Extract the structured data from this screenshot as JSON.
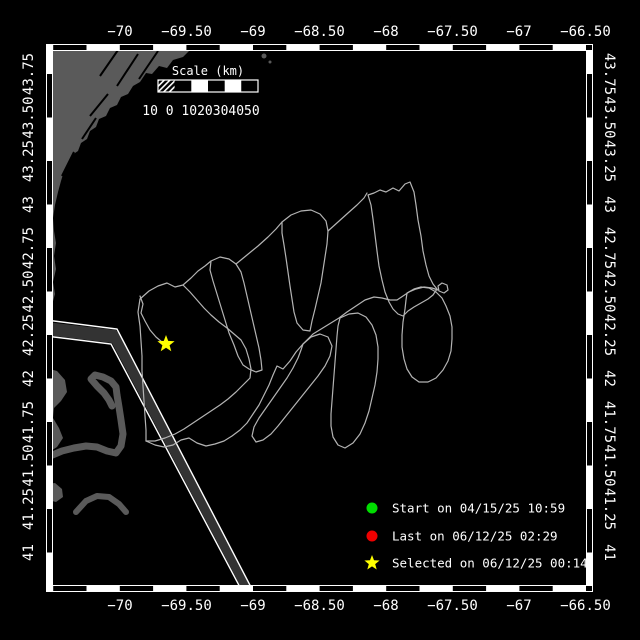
{
  "map": {
    "colors": {
      "background": "#000000",
      "land": "#5a5a5a",
      "track": "#b4b4b4",
      "frame": "#ffffff",
      "start_marker": "#00dd00",
      "last_marker": "#ee0000",
      "selected_marker": "#ffff00",
      "corridor_fill": "#333333"
    },
    "frame": {
      "left": 46,
      "top": 44,
      "right": 593,
      "bottom": 592,
      "inner_left": 52,
      "inner_top": 50,
      "inner_right": 587,
      "inner_bottom": 586,
      "hcells": {
        "first": 53.2,
        "period": 33.3
      },
      "vcells": {
        "first": 74,
        "period": 43.5
      }
    },
    "axes": {
      "top": {
        "y": 36,
        "ticks": [
          {
            "label": "−70",
            "x": 120
          },
          {
            "label": "−69.50",
            "x": 186.5
          },
          {
            "label": "−69",
            "x": 253
          },
          {
            "label": "−68.50",
            "x": 319.5
          },
          {
            "label": "−68",
            "x": 386
          },
          {
            "label": "−67.50",
            "x": 452.5
          },
          {
            "label": "−67",
            "x": 519
          },
          {
            "label": "−66.50",
            "x": 585.5
          }
        ]
      },
      "bottom": {
        "y": 610,
        "ticks": [
          {
            "label": "−70",
            "x": 120
          },
          {
            "label": "−69.50",
            "x": 186.5
          },
          {
            "label": "−69",
            "x": 253
          },
          {
            "label": "−68.50",
            "x": 319.5
          },
          {
            "label": "−68",
            "x": 386
          },
          {
            "label": "−67.50",
            "x": 452.5
          },
          {
            "label": "−67",
            "x": 519
          },
          {
            "label": "−66.50",
            "x": 585.5
          }
        ]
      },
      "left": {
        "x": 33,
        "ticks": [
          {
            "label": "43.75",
            "y": 74
          },
          {
            "label": "43.50",
            "y": 117.5
          },
          {
            "label": "43.25",
            "y": 161
          },
          {
            "label": "43",
            "y": 204.5
          },
          {
            "label": "42.75",
            "y": 248
          },
          {
            "label": "42.50",
            "y": 291.5
          },
          {
            "label": "42.25",
            "y": 335
          },
          {
            "label": "42",
            "y": 378.5
          },
          {
            "label": "41.75",
            "y": 422
          },
          {
            "label": "41.50",
            "y": 465.5
          },
          {
            "label": "41.25",
            "y": 509
          },
          {
            "label": "41",
            "y": 552.5
          }
        ]
      },
      "right": {
        "x": 605,
        "ticks": [
          {
            "label": "43.75",
            "y": 74
          },
          {
            "label": "43.50",
            "y": 117.5
          },
          {
            "label": "43.25",
            "y": 161
          },
          {
            "label": "43",
            "y": 204.5
          },
          {
            "label": "42.75",
            "y": 248
          },
          {
            "label": "42.50",
            "y": 291.5
          },
          {
            "label": "42.25",
            "y": 335
          },
          {
            "label": "42",
            "y": 378.5
          },
          {
            "label": "41.75",
            "y": 422
          },
          {
            "label": "41.50",
            "y": 465.5
          },
          {
            "label": "41.25",
            "y": 509
          },
          {
            "label": "41",
            "y": 552.5
          }
        ]
      }
    },
    "scalebar": {
      "title": "Scale (km)",
      "numbers": "10 0 1020304050",
      "x": 158,
      "y": 80,
      "width": 100,
      "height": 12
    },
    "legend": {
      "items": [
        {
          "marker": "circle",
          "color": "#00dd00",
          "label": "Start on 04/15/25 10:59"
        },
        {
          "marker": "circle",
          "color": "#ee0000",
          "label": "Last on 06/12/25 02:29"
        },
        {
          "marker": "star",
          "color": "#ffff00",
          "label": "Selected on 06/12/25 00:14"
        }
      ]
    },
    "markers": {
      "start": {
        "transform": "translate(146,440)"
      },
      "last": {
        "transform": "translate(170,351)"
      },
      "selected_star_points": "166,335 168.2,340.9 174.6,341.2 169.6,345.2 171.3,351.3 166,347.8 160.7,351.3 162.4,345.2 157.4,341.2 163.8,340.9"
    },
    "legend_star_points": "372,555 374,560.3 379.6,560.5 375.2,564.1 376.7,569.5 372,566.4 367.3,569.5 368.8,564.1 364.4,560.5 370,560.3",
    "land": {
      "maine": "52,50 190,50 183,57 173,60 167,68 159,66 152,74 146,73 140,82 133,86 128,94 121,97 117,105 110,108 106,116 99,119 96,127 90,131 87,139 81,143 78,151 72,155 69,164 64,171 61,181 58,192 55,205 53,218 54,231 56,243 54,256 56,269 53,282 55,294 52,305",
      "streaks": "M118,50 L100,76 M138,54 L117,86 M158,51 L139,79 M96,118 L82,139 M108,94 L90,116 M74,152 L62,176",
      "mainland": "46,368 57,371 65,380 67,392 61,401 54,408 53,418 59,428 63,438 57,447 49,452 46,452",
      "cape_arm": "M50,456 L62,451 74,448 86,446 97,447 107,451 116,453 121,446 123,434 121,420 119,407 117,395 116,387 111,381 103,377 95,375 91,379 97,386 104,393 109,400 112,406",
      "islands": "M76,512 L86,501 97,496 109,497 119,504 126,512",
      "island_blob": "46,484 55,483 62,489 63,497 56,502 48,500 46,495"
    },
    "corridor": {
      "fill": "46,322 116,330 119,334 253,591 243,591 112,343 46,335",
      "line1": "46,320 117,329 253,591",
      "line2": "46,336 111,344 242,591"
    },
    "track": {
      "segments": {
        "tail_star": "140,296 143,304 141,313 145,321 150,330 156,337 162,342 166,345",
        "loop_a": "140,299 149,291 158,286 167,283 175,287 183,285 190,292 197,300 204,308 211,315 219,322 227,328 234,334 241,340 246,349 249,359 251,369 250,378 243,385 236,392 228,399 220,405 211,411 202,417 193,423 184,429 175,434 165,438 155,441 146,441",
        "loop_a_left": "140,299 138,312 140,326 141,341 142,356 142,371 143,386 144,401 145,416 146,430 146,441",
        "conn_ab": "183,285 191,278 198,271 205,266 211,261",
        "loop_b": "211,261 220,257 229,259 236,264 241,272 244,283 247,296 250,309 253,322 256,335 259,348 261,360 262,370 256,372 249,369 243,365 238,356 234,345 229,333 225,320 221,307 217,294 213,281 210,270 211,261",
        "conn_bc": "236,264 247,255 258,246 268,237 276,229 282,222",
        "loop_c": "282,222 291,215 301,211 311,210 320,214 326,221 328,231 327,244 325,257 323,270 321,283 318,296 315,309 312,321 310,331 303,330 297,323 294,312 292,299 290,286 288,272 286,258 284,245 282,233 282,222",
        "conn_cd": "328,231 338,222 348,213 357,205 364,198 367,193",
        "loop_d": "368,195 374,193 380,190 386,192 393,188 399,191 405,184 410,182 414,192 416,205 418,220 421,236 423,251 426,265 429,276 433,284 437,289 433,295 428,299 421,303 414,307 408,311 403,316 398,314 393,309 389,302 385,292 382,280 379,266 377,251 375,235 373,219 371,205 368,195",
        "knot": "439,291 444,293 448,290 447,285 442,283 438,286 439,291",
        "loop_h": "407,293 414,289 421,287 429,288 436,292 442,298 446,306 450,316 452,327 452,339 451,351 448,361 443,370 436,378 428,382 419,382 412,377 407,369 404,359 402,347 402,335 403,322 405,309 406,300 407,293",
        "loop_f": "303,344 311,337 320,334 328,337 332,346 330,356 325,366 318,376 310,386 302,396 294,406 286,416 278,426 271,434 263,440 256,442 252,436 254,427 259,418 266,408 273,398 280,388 287,378 293,368 298,358 301,350 303,344",
        "loop_g": "340,318 349,314 358,313 366,317 372,325 376,335 378,347 378,359 377,372 375,385 372,398 369,411 365,423 360,434 353,443 345,448 338,445 333,437 331,426 331,414 332,401 333,388 334,375 335,362 336,349 337,336 338,326 340,318",
        "spine": "146,441 155,445 164,447 173,445 181,440 189,438 197,443 206,446 215,444 224,441 232,436 240,430 247,423 253,414 259,405 264,395 269,385 273,375 277,366 283,369 290,361 296,352 303,344 313,334 326,326 339,318 347,312 356,306 365,300 374,297 382,298 390,300 397,300 403,296 409,292 416,289 424,287 432,288 438,290"
      }
    }
  }
}
